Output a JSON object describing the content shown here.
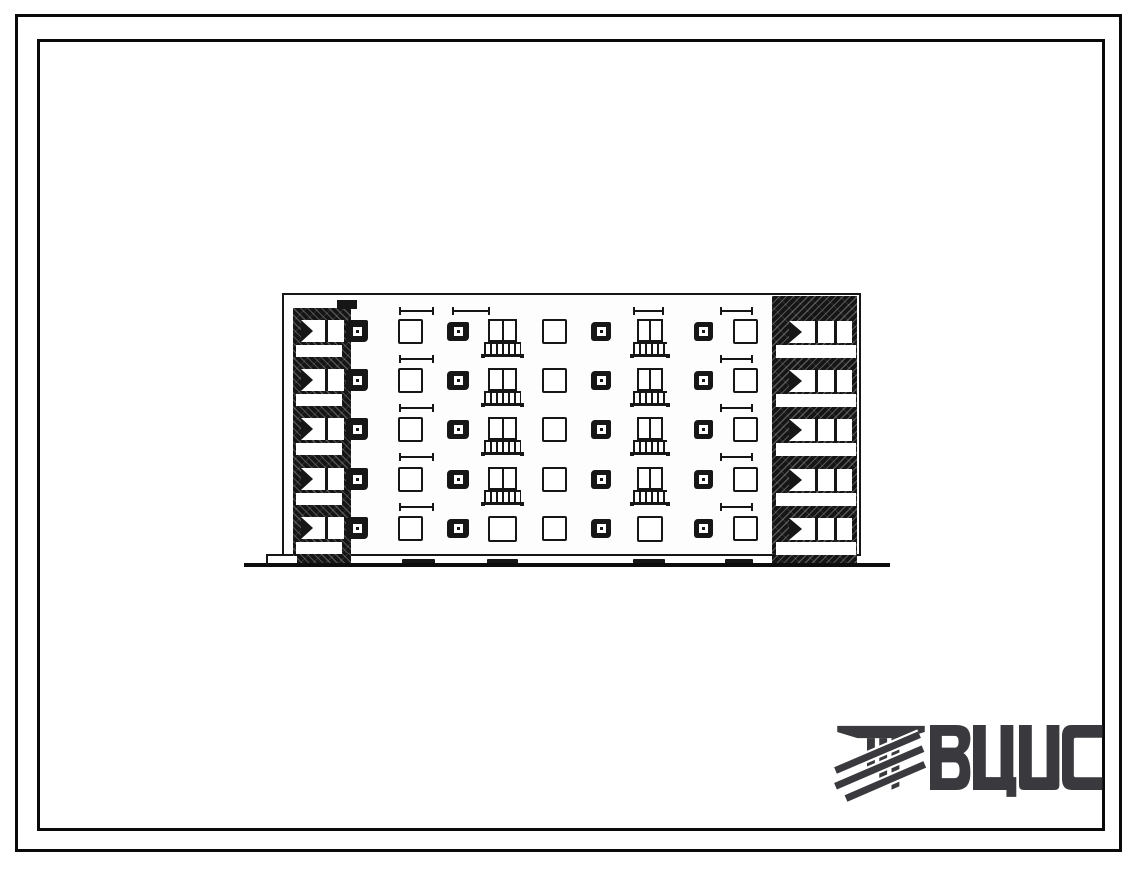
{
  "page": {
    "background": "#ffffff",
    "ink": "#161616",
    "border_color": "#0a0a0a"
  },
  "frames": {
    "outer": {
      "left": 15,
      "top": 14,
      "width": 1107,
      "height": 838,
      "thickness": 3
    },
    "inner": {
      "left": 37,
      "top": 39,
      "width": 1068,
      "height": 792,
      "thickness": 3
    }
  },
  "drawing": {
    "subject": "five-storey-building-elevation",
    "floors": 5,
    "facade": {
      "left": 282,
      "top": 293,
      "width": 579,
      "height": 263
    },
    "row_tops": [
      319,
      368,
      417,
      467,
      516
    ],
    "columns": [
      {
        "type": "plain",
        "x": 398,
        "w": 25
      },
      {
        "type": "small",
        "x": 447,
        "w": 22
      },
      {
        "type": "french",
        "x": 488,
        "w": 29
      },
      {
        "type": "plain",
        "x": 542,
        "w": 25
      },
      {
        "type": "small",
        "x": 591,
        "w": 20
      },
      {
        "type": "french",
        "x": 637,
        "w": 26
      },
      {
        "type": "small",
        "x": 694,
        "w": 19
      },
      {
        "type": "plain",
        "x": 733,
        "w": 25
      }
    ],
    "window_heights": {
      "plain": 25,
      "french": 23,
      "small": 19,
      "small_dy": 3
    },
    "railing": {
      "dx": -4,
      "dw": 8,
      "dy": 23,
      "h": 15
    },
    "left_loggia": {
      "x": 293,
      "w": 58,
      "top": 308,
      "bottom": 556,
      "cap": {
        "x": 337,
        "y": 300,
        "w": 20,
        "h": 9
      },
      "slab": {
        "x": 296,
        "w": 46,
        "dy": 26,
        "h": 12
      },
      "window": {
        "x": 301,
        "w": 43,
        "dy": 1,
        "h": 22
      },
      "stair_window": {
        "x": 346,
        "w": 22,
        "dy": 1,
        "h": 22
      },
      "base": {
        "x": 297,
        "y": 553,
        "w": 54,
        "h": 13
      }
    },
    "right_loggia": {
      "x": 772,
      "w": 85,
      "top": 296,
      "bottom": 556,
      "slab": {
        "x": 776,
        "w": 80,
        "dy": 26,
        "h": 13
      },
      "window": {
        "x": 789,
        "w": 63,
        "dy": 2,
        "h": 22
      },
      "base": {
        "x": 772,
        "y": 553,
        "w": 85,
        "h": 14
      }
    },
    "ticks": {
      "ys": [
        307,
        355,
        404,
        453,
        503
      ],
      "all_rows": [
        {
          "x": 399,
          "w": 35
        },
        {
          "x": 720,
          "w": 33
        }
      ],
      "top_row_only": [
        {
          "x": 452,
          "w": 38
        },
        {
          "x": 633,
          "w": 31
        }
      ]
    },
    "vents": {
      "y": 559,
      "h": 6,
      "items": [
        [
          402,
          33
        ],
        [
          487,
          31
        ],
        [
          633,
          32
        ],
        [
          725,
          28
        ]
      ]
    },
    "ground": {
      "x": 244,
      "y": 563,
      "w": 646,
      "h": 4
    },
    "wall_step": {
      "x": 266,
      "y": 554,
      "w": 18
    }
  },
  "logo": {
    "text": "ВЦИС",
    "color": "#3a3a3e",
    "emblem": "beam-columns-diagonal-braces"
  }
}
